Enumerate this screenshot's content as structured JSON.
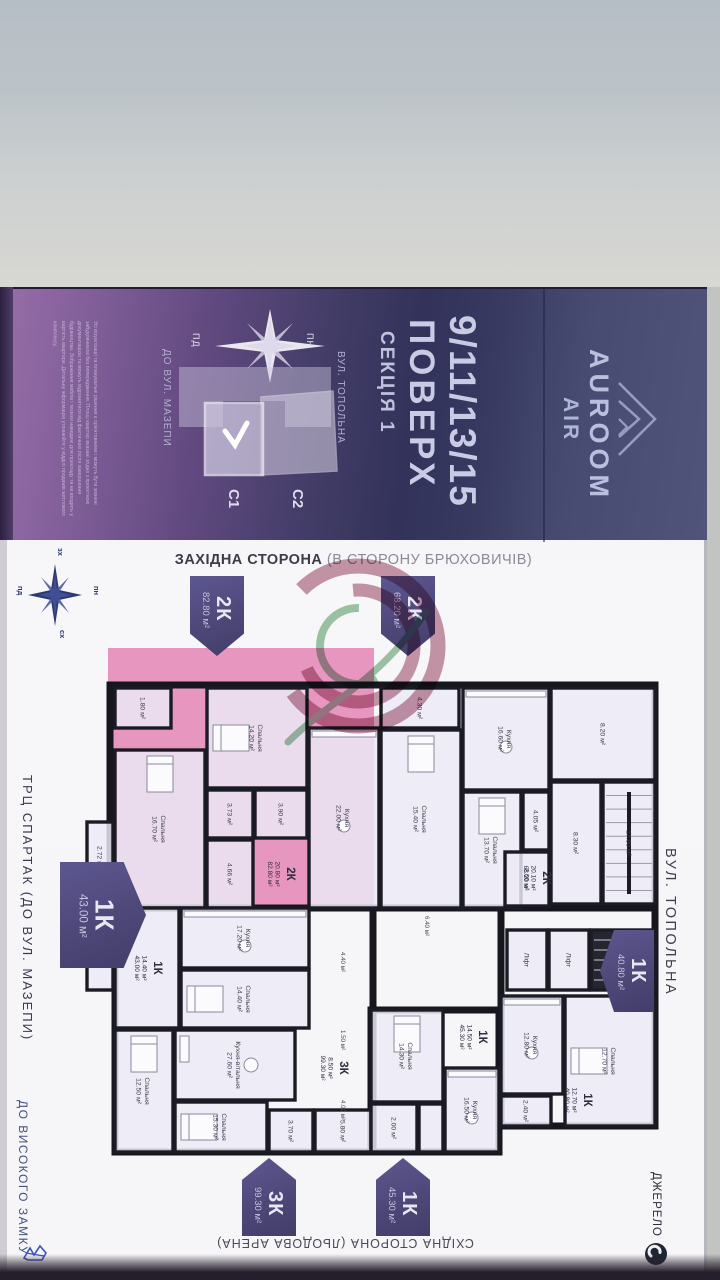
{
  "band": {
    "disclaimer": "Усі візуалізації та планувальні рішення є орієнтовними і можуть бути змінені забудовником без попередження. Площі квартир вказані згідно з проектною документацією та можуть відрізнятися від фактичних після завершення будівництва. Зображення меблів і техніки наведені для прикладу та не входять у вартість квартири. Детальну інформацію уточнюйте у відділі продажів житлового комплексу.",
    "compass": {
      "n": "ПН",
      "s": "ПД"
    },
    "minimap": {
      "c1": "С1",
      "c2": "С2",
      "street": "ВУЛ. ТОПОЛЬНА",
      "direction": "ДО ВУЛ. МАЗЕПИ"
    },
    "floors": "9/11/13/15",
    "floors_label": "ПОВЕРХ",
    "section": "СЕКЦІЯ 1",
    "brand": {
      "name": "AUROOM",
      "sub": "AIR"
    }
  },
  "plan": {
    "west_caption": "ЗАХІДНА СТОРОНА",
    "west_caption_sub": " (В СТОРОНУ БРЮХОВИЧІВ)",
    "east_caption": "СХІДНА СТОРОНА (ЛЬОДОВА АРЕНА)",
    "street_right": "ВУЛ. ТОПОЛЬНА",
    "street_left": "ТРЦ СПАРТАК (ДО ВУЛ. МАЗЕПИ)",
    "street_left_bottom": "ДО ВИСОКОГО ЗАМКУ",
    "source": "ДЖЕРЕЛО",
    "compass": {
      "n": "пн",
      "s": "пд",
      "w": "зх",
      "e": "сх"
    },
    "accent_pink": "#dd5a9e",
    "tag_purple": "#4e4879",
    "tags": [
      {
        "code": "2К",
        "area": "82.80 м²",
        "dir": "down",
        "x": 190,
        "y": 576,
        "w": 54,
        "h": 80
      },
      {
        "code": "2К",
        "area": "68.20 м²",
        "dir": "down",
        "x": 381,
        "y": 576,
        "w": 54,
        "h": 80
      },
      {
        "code": "1К",
        "area": "43.00 м²",
        "dir": "right",
        "x": 60,
        "y": 862,
        "w": 86,
        "h": 106,
        "big": true
      },
      {
        "code": "1К",
        "area": "40.80 м²",
        "dir": "left",
        "x": 600,
        "y": 930,
        "w": 54,
        "h": 82
      },
      {
        "code": "3К",
        "area": "99.30 м²",
        "dir": "up",
        "x": 242,
        "y": 1158,
        "w": 54,
        "h": 78
      },
      {
        "code": "1К",
        "area": "45.30 м²",
        "dir": "up",
        "x": 376,
        "y": 1158,
        "w": 54,
        "h": 78
      }
    ],
    "outlines": [
      [
        35,
        5,
        545,
        223
      ],
      [
        40,
        228,
        258,
        244
      ],
      [
        296,
        330,
        128,
        142
      ],
      [
        426,
        228,
        154,
        218
      ]
    ],
    "rooms": [
      {
        "n": "Спальня",
        "a": "16.70 м²",
        "x": 40,
        "y": 70,
        "w": 90,
        "h": 158,
        "f": "bed"
      },
      {
        "n": "Спальня",
        "a": "14.20 м²",
        "x": 132,
        "y": 8,
        "w": 100,
        "h": 100,
        "f": "bedh"
      },
      {
        "n": "Кухня",
        "a": "22.00 м²",
        "x": 234,
        "y": 48,
        "w": 70,
        "h": 180,
        "f": "kitchen"
      },
      {
        "a": "3.90 м²",
        "x": 180,
        "y": 110,
        "w": 52,
        "h": 48
      },
      {
        "a": "4.66 м²",
        "x": 132,
        "y": 160,
        "w": 46,
        "h": 68
      },
      {
        "a": "3.73 м²",
        "x": 132,
        "y": 110,
        "w": 46,
        "h": 48
      },
      {
        "a": "2.72 м²",
        "x": 12,
        "y": 142,
        "w": 26,
        "h": 70
      },
      {
        "a": "1.80 м²",
        "x": 40,
        "y": 8,
        "w": 56,
        "h": 40
      },
      {
        "a": "4.30 м²",
        "x": 306,
        "y": 8,
        "w": 78,
        "h": 40
      },
      {
        "n": "Спальня",
        "a": "15.40 м²",
        "x": 306,
        "y": 50,
        "w": 80,
        "h": 178,
        "f": "bed"
      },
      {
        "n": "Кухня",
        "a": "16.60 м²",
        "x": 388,
        "y": 8,
        "w": 86,
        "h": 102,
        "f": "kitchen"
      },
      {
        "n": "Спальня",
        "a": "13.70 м²",
        "x": 388,
        "y": 112,
        "w": 58,
        "h": 116,
        "f": "bed"
      },
      {
        "a": "4.05 м²",
        "x": 448,
        "y": 112,
        "w": 26,
        "h": 58
      },
      {
        "a": "8.20 м²",
        "x": 476,
        "y": 8,
        "w": 104,
        "h": 92
      },
      {
        "a": "8.30 м²",
        "x": 476,
        "y": 102,
        "w": 50,
        "h": 122
      },
      {
        "n": "17.80 м²",
        "x": 528,
        "y": 102,
        "w": 52,
        "h": 122,
        "f": "stairs"
      },
      {
        "a": "2.60 м²",
        "x": 430,
        "y": 172,
        "w": 44,
        "h": 54
      },
      {
        "n": "Ліфт",
        "x": 432,
        "y": 250,
        "w": 40,
        "h": 60,
        "f": "lift"
      },
      {
        "n": "Ліфт",
        "x": 474,
        "y": 250,
        "w": 40,
        "h": 60,
        "f": "lift"
      },
      {
        "x": 516,
        "y": 250,
        "w": 64,
        "h": 60,
        "f": "darkstairs"
      },
      {
        "a": "2.00 м²",
        "x": 12,
        "y": 244,
        "w": 26,
        "h": 66
      },
      {
        "n": "Кухня",
        "a": "17.20 м²",
        "x": 106,
        "y": 228,
        "w": 128,
        "h": 60,
        "f": "kitchen"
      },
      {
        "n": "Спальня",
        "a": "14.40 м²",
        "x": 106,
        "y": 290,
        "w": 128,
        "h": 58,
        "f": "bedh"
      },
      {
        "x": 40,
        "y": 228,
        "w": 64,
        "h": 120
      },
      {
        "n": "Спальня",
        "a": "12.50 м²",
        "x": 40,
        "y": 350,
        "w": 58,
        "h": 122,
        "f": "bed"
      },
      {
        "n": "Кухня-вітальня",
        "a": "27.60 м²",
        "x": 100,
        "y": 350,
        "w": 120,
        "h": 70,
        "f": "table"
      },
      {
        "n": "Спальня",
        "a": "15.30 м²",
        "x": 100,
        "y": 422,
        "w": 92,
        "h": 50,
        "f": "bedh"
      },
      {
        "a": "3.70 м²",
        "x": 194,
        "y": 430,
        "w": 44,
        "h": 42
      },
      {
        "a": "5.80 м²",
        "x": 240,
        "y": 430,
        "w": 56,
        "h": 42
      },
      {
        "n": "Спальня",
        "a": "14.30 м²",
        "x": 296,
        "y": 330,
        "w": 72,
        "h": 92,
        "f": "bed"
      },
      {
        "n": "Кухня",
        "a": "16.50 м²",
        "x": 370,
        "y": 388,
        "w": 54,
        "h": 84,
        "f": "kitchen"
      },
      {
        "a": "2.00 м²",
        "x": 296,
        "y": 424,
        "w": 46,
        "h": 48
      },
      {
        "x": 344,
        "y": 424,
        "w": 24,
        "h": 48
      },
      {
        "n": "Кухня",
        "a": "12.80 м²",
        "x": 426,
        "y": 316,
        "w": 62,
        "h": 98,
        "f": "kitchen"
      },
      {
        "n": "Спальня",
        "a": "12.70 м²",
        "x": 490,
        "y": 316,
        "w": 90,
        "h": 130,
        "f": "bedh"
      },
      {
        "a": "2.40 м²",
        "x": 426,
        "y": 416,
        "w": 50,
        "h": 30
      }
    ],
    "apt_labels": [
      {
        "code": "2К",
        "l1": "20.80 м²",
        "l2": "82.80 м²",
        "x": 205,
        "y": 194
      },
      {
        "code": "2К",
        "l1": "20.10 м²",
        "l2": "68.20 м²",
        "x": 461,
        "y": 198
      },
      {
        "code": "1К",
        "l1": "14.40 м²",
        "l2": "43.00 м²",
        "x": 72,
        "y": 288
      },
      {
        "code": "3К",
        "l1": "8.50 м²",
        "l2": "99.30 м²",
        "x": 258,
        "y": 388
      },
      {
        "code": "1К",
        "l1": "14.50 м²",
        "l2": "45.30 м²",
        "x": 397,
        "y": 357
      },
      {
        "code": "1К",
        "l1": "12.70 м²",
        "l2": "40.80 м²",
        "x": 502,
        "y": 420
      }
    ],
    "free_labels": [
      {
        "t": "6.40 м²",
        "x": 350,
        "y": 246
      },
      {
        "t": "4.40 м²",
        "x": 266,
        "y": 282
      },
      {
        "t": "1.50 м²",
        "x": 266,
        "y": 360
      },
      {
        "t": "4.00 м²",
        "x": 266,
        "y": 430
      }
    ]
  }
}
